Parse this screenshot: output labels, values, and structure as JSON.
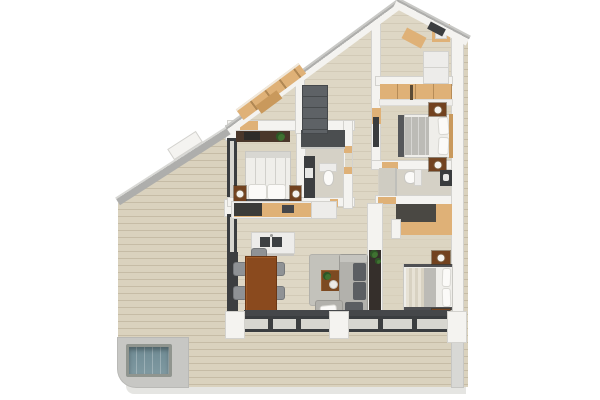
{
  "scene": {
    "type": "3d-floor-plan-render",
    "description": "Top-down 3D render of an apartment with three bedrooms, two bathrooms, open kitchen-living-dining area, wrap-around wooden terrace, plunge pool and sloped roofline walls",
    "canvas": {
      "width": 600,
      "height": 400
    },
    "background": "#ffffff"
  },
  "palette": {
    "bg": "#ffffff",
    "terrace": "#dad2be",
    "plankLine": "rgba(125,110,80,0.22)",
    "interior": "#ded7c5",
    "roomTint": "#dbd3bf",
    "bathFloor": "#d5d1c6",
    "wallWhite": "#f4f3f0",
    "wallEdge": "#d3d2ce",
    "cap": "#aeaeac",
    "capLight": "#c9c9c6",
    "pad": "#c7c7c4",
    "shadow": "#e5e5e2",
    "oak": "#dfb177",
    "oakDark": "#c9995c",
    "woodDark": "#8a4a1e",
    "brown": "#72421f",
    "darkUnit": "#3c3e40",
    "glassFrame": "#3a3d40",
    "glassPane": "#d7d6d0",
    "sofa": "#b2b1ac",
    "sofaLight": "#c5c4bf",
    "cushion": "#5b5e62",
    "rug": "#c3c2bb",
    "bedWhite": "#efeeea",
    "bedGray": "#bcbbb6",
    "frameDark": "#4f5053",
    "wardrobeGray": "#5e6266",
    "alcove": "#4a4843",
    "green": "#3f7231",
    "greenDark": "#2d5526",
    "poolWater": "#7f99a1",
    "poolRim": "#90958f",
    "appliance": "#edecea",
    "matDark": "#45474a",
    "tvDark": "#352f2b",
    "deskDark": "#4a372a",
    "shower": "#4b4e50"
  },
  "inventory": {
    "outdoor": [
      "wrap-around wooden deck terrace",
      "plunge pool on concrete pad",
      "low parapet wall",
      "sloped roofline walls"
    ],
    "bedroom_1": [
      "double bed with white duvet and two pillows",
      "desk with laptop and plant",
      "two wooden nightstands with lamps",
      "full-height glazing to terrace"
    ],
    "bathroom_1": [
      "dark vanity",
      "toilet",
      "dark shower area"
    ],
    "hallway": [
      "gray wardrobe",
      "wooden bench along sloped wall"
    ],
    "bedroom_2": [
      "oak wardrobe wall",
      "double bed with gray and white bedding",
      "two nightstands with lamps",
      "wall-mounted media unit",
      "stacked white appliances in roof closet"
    ],
    "bathroom_2": [
      "toilet",
      "dark vanity",
      "shower zone"
    ],
    "bedroom_3": [
      "L-shaped oak wardrobe alcove",
      "double bed with striped duvet",
      "two nightstands with lamps",
      "dark media wall with plants"
    ],
    "kitchen": [
      "wall counter with cooktop block and sink",
      "white island with twin basins and faucet",
      "fridge cabinet"
    ],
    "dining": [
      "rectangular walnut table",
      "six gray chairs"
    ],
    "living": [
      "gray area rug",
      "wooden coffee table with plant and bowl",
      "L-shaped gray sofa with dark cushions and white throw pillow"
    ],
    "envelope": [
      "dark-framed sliding glass doors on south face",
      "white structural piers",
      "east perimeter wall"
    ]
  }
}
